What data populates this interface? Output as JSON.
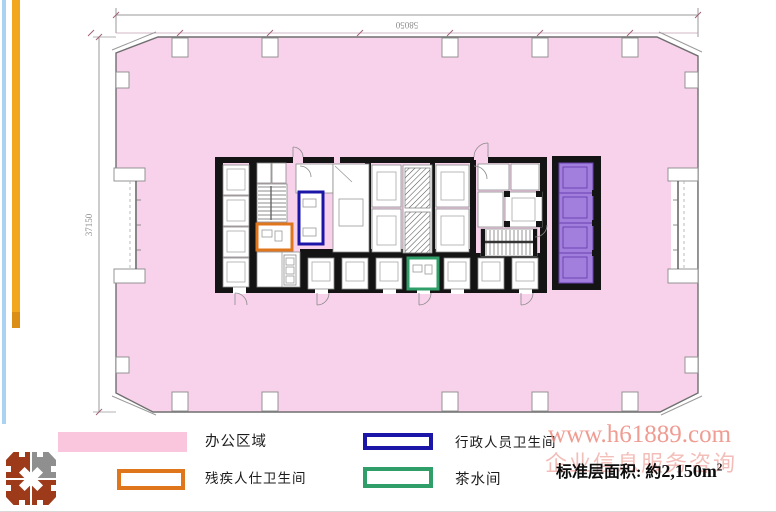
{
  "plan": {
    "dim_top": "58050",
    "dim_left": "37150"
  },
  "legend": {
    "items": [
      {
        "label": "办公区域"
      },
      {
        "label": "残疾人仕卫生间"
      },
      {
        "label": "行政人员卫生间"
      },
      {
        "label": "茶水间"
      }
    ]
  },
  "watermark": {
    "line1": "www.h61889.com",
    "line2": "企业信息服务咨询"
  },
  "area_note": {
    "label": "标准层面积: 約",
    "value": "2,150m",
    "sup": "2"
  },
  "colors": {
    "office": "#f8d2ea",
    "office_swatch": "#f9c6de",
    "lift_bank": "#a27fdc",
    "lift_bank_border": "#6a3fb0",
    "disabled_wc": "#e0761c",
    "admin_wc": "#1c16a8",
    "pantry": "#2f9e68",
    "watermark1": "#ec8478",
    "watermark2": "#ee9c94",
    "bar_orange": "#f2a71f",
    "bar_orange_dark": "#db8f17",
    "bar_blue": "#a9d3f0",
    "logo_brick": "#9c3a1a",
    "logo_gray": "#8f8f8f",
    "wall": "#141414",
    "outline": "#777777"
  }
}
